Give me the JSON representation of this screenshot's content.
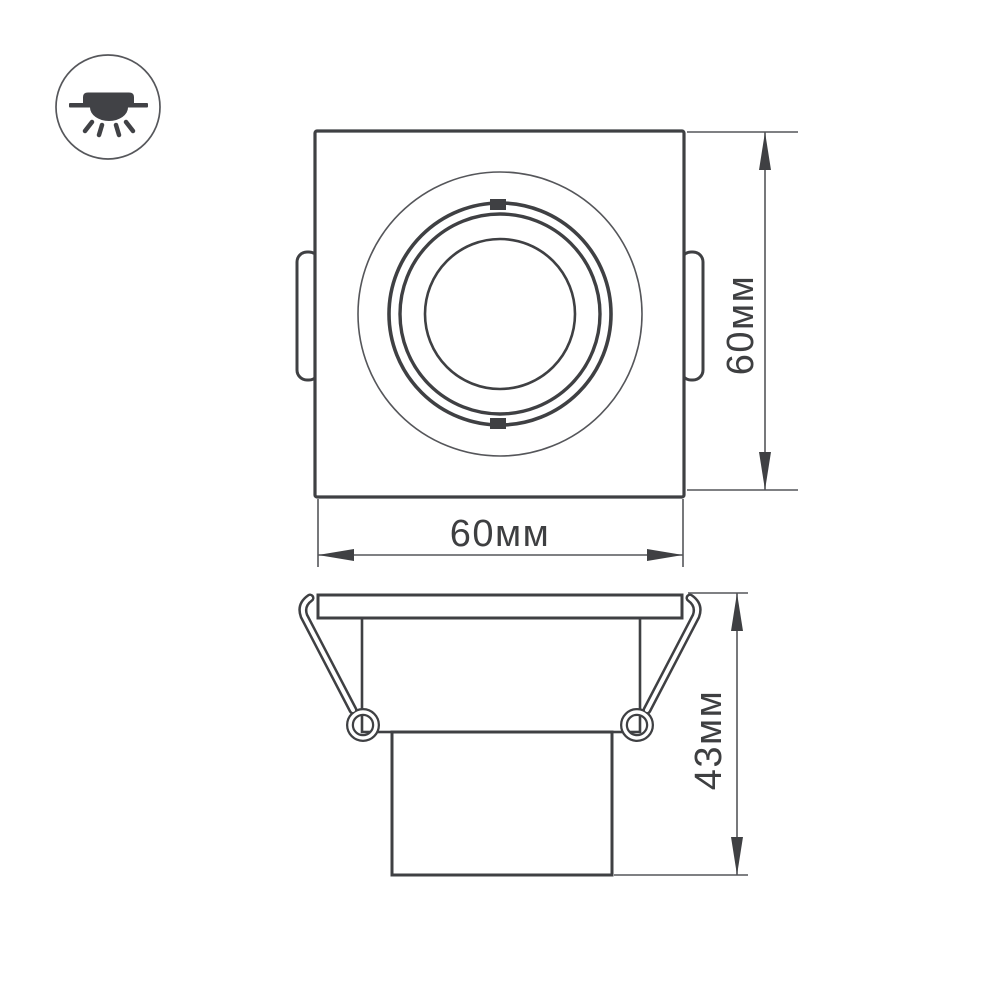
{
  "drawing": {
    "icon": {
      "name": "recessed-downlight-icon"
    },
    "top_view": {
      "width_dim": {
        "label": "60мм"
      },
      "height_dim": {
        "label": "60мм"
      }
    },
    "side_view": {
      "depth_dim": {
        "label": "43мм"
      }
    },
    "colors": {
      "line_dark": "#3f4043",
      "line_thin": "#55565a",
      "text": "#3e3f41",
      "background": "#ffffff"
    }
  }
}
